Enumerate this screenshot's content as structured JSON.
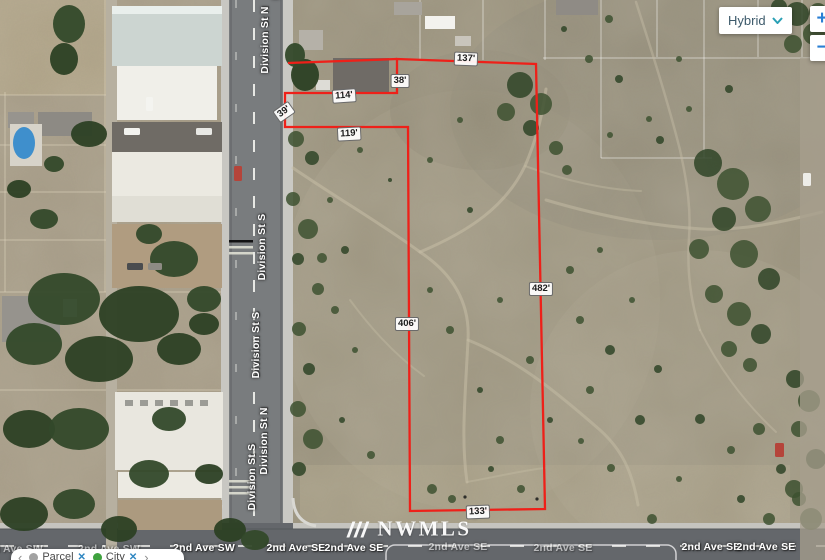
{
  "map": {
    "layer_selector": {
      "value": "Hybrid"
    },
    "zoom": {
      "in": "+",
      "out": "−"
    }
  },
  "watermark": {
    "brand": "NWMLS",
    "tm": "™"
  },
  "parcel_overlay": {
    "outline_color": "#ee2019",
    "measurements": [
      "137'",
      "38'",
      "114'",
      "39'",
      "119'",
      "406'",
      "482'",
      "133'"
    ]
  },
  "street_labels": {
    "division": [
      "Division St N",
      "Division St N",
      "Division St S",
      "Division St S",
      "Division St S",
      "Division St N"
    ],
    "second_ave": [
      "2nd Ave SW",
      "2nd Ave SW",
      "2nd Ave SW",
      "2nd Ave SE",
      "2nd Ave SE",
      "2nd Ave SE",
      "2nd Ave SE",
      "2nd Ave SE",
      "2nd Ave SE"
    ]
  },
  "filter_bar": {
    "prev": "‹",
    "next": "›",
    "chips": [
      {
        "label": "Parcel",
        "dot_color": "#a2a2a2",
        "remove": "✕"
      },
      {
        "label": "City",
        "dot_color": "#3fa23f",
        "remove": "✕"
      }
    ]
  }
}
